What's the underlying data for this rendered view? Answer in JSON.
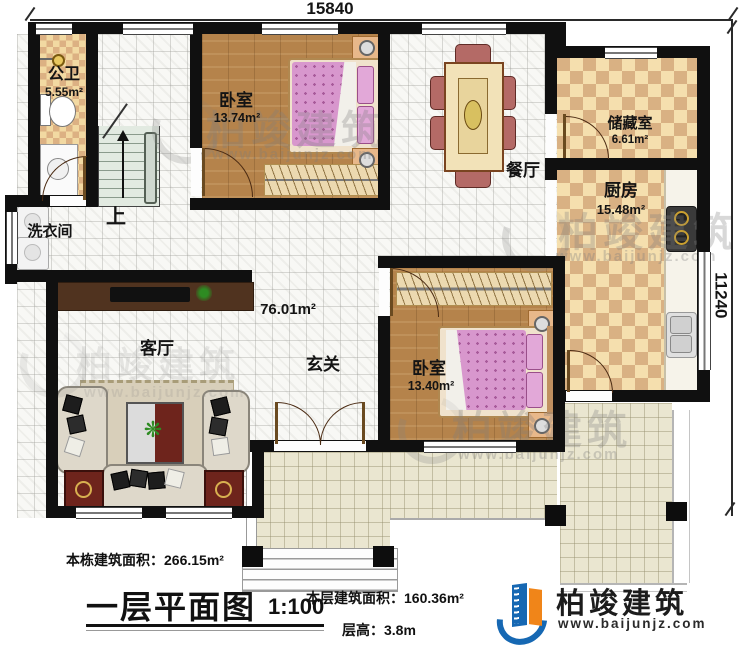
{
  "dimensions": {
    "top": "15840",
    "right": "11240"
  },
  "rooms": {
    "bathroom": {
      "name": "公卫",
      "area": "5.55m²"
    },
    "laundry": {
      "name": "洗衣间"
    },
    "stairs": {
      "direction": "上"
    },
    "bedroom1": {
      "name": "卧室",
      "area": "13.74m²"
    },
    "dining": {
      "name": "餐厅"
    },
    "storage": {
      "name": "储藏室",
      "area": "6.61m²"
    },
    "kitchen": {
      "name": "厨房",
      "area": "15.48m²"
    },
    "foyer": {
      "name": "玄关"
    },
    "living": {
      "name": "客厅"
    },
    "bedroom2": {
      "name": "卧室",
      "area": "13.40m²"
    },
    "hall": {
      "area": "76.01m²"
    }
  },
  "annotations": {
    "building_area_label": "本栋建筑面积：",
    "building_area_value": "266.15m²",
    "plan_title": "一层平面图",
    "scale": "1:100",
    "floor_area_label": "本层建筑面积：",
    "floor_area_value": "160.36m²",
    "floor_height_label": "层高：",
    "floor_height_value": "3.8m"
  },
  "logo": {
    "name": "柏竣建筑",
    "url": "www.baijunjz.com"
  },
  "watermark": {
    "text": "柏竣建筑",
    "url": "www.baijunjz.com"
  },
  "colors": {
    "wall": "#101010",
    "checker_light": "#f5dfae",
    "checker_dark": "#d9b183",
    "wood": "#b5834b",
    "tile": "#f8f8f5",
    "patio": "#eae6d0",
    "bed_pink": "#d897cd",
    "logo_blue": "#1668b3",
    "logo_orange": "#f08519"
  }
}
